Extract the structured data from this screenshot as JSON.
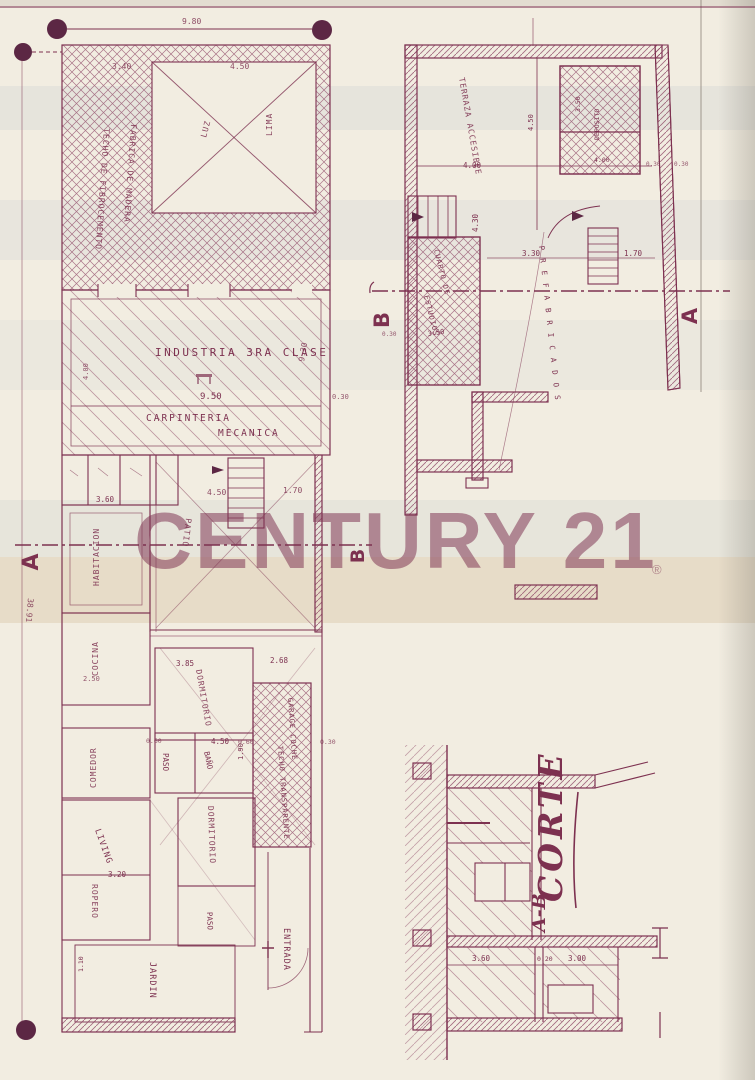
{
  "watermark": {
    "brand": "CENTURY 21",
    "registered": "®"
  },
  "site": {
    "front_width": "9.80",
    "side_length": "38.91"
  },
  "ground": {
    "roof1": "TECHO DE FIBROCEMENTO",
    "roof2": "FABRICA DE MADERA",
    "luz": "LUZ",
    "lima": "LIMA",
    "d340": "3.40",
    "d450top": "4.50",
    "industria": "INDUSTRIA 3RA CLASE",
    "d950": "9.50",
    "carpinteria": "CARPINTERIA",
    "mecanica": "MECANICA",
    "d930": "9.30",
    "d030": "0.30",
    "d400side": "4.00",
    "d360": "3.60",
    "habitacion": "HABITACION",
    "patio": "PATIO",
    "d450patio": "4.50",
    "d170": "1.70",
    "cocina": "COCINA",
    "d250": "2.50",
    "dormitorio": "DORMITORIO",
    "d385": "3.85",
    "d268": "2.68",
    "garage1": "GARAGE COCHE",
    "garage2": "TECHO TRANSPARENTE",
    "d060": "0.60",
    "d030b": "0.30",
    "comedor": "COMEDOR",
    "d450med": "4.50",
    "d190": "1.90",
    "d060b": "0.60",
    "paso": "PASO",
    "bano": "BAÑO",
    "living": "LIVING",
    "d320": "3.20",
    "ropero": "ROPERO",
    "dormitorio2": "DORMITORIO",
    "paso2": "PASO",
    "jardin": "JARDIN",
    "entrada": "ENTRADA",
    "d110": "1.10"
  },
  "upper": {
    "terraza": "TERRAZA ACCESIBLE",
    "d400": "4.00",
    "d450": "4.50",
    "deposito": "DEPOSITO",
    "d350dep": "3.50",
    "d400dep": "4.00",
    "d030a": "0.30",
    "d030b": "0.30",
    "d430": "4.30",
    "d330": "3.30",
    "d170": "1.70",
    "cuarto1": "CUARTO DE",
    "cuarto2": "ESTUDIOS",
    "d350": "3.50",
    "d030c": "0.30",
    "prefabricados": "PREFABRICADOS"
  },
  "markers": {
    "a_ground": "A",
    "b_ground": "B",
    "a_upper": "A",
    "b_upper": "B"
  },
  "corte": {
    "title": "CORTE",
    "sheet": "A-B",
    "d360": "3.60",
    "d020": "0.20",
    "d300": "3.00"
  }
}
